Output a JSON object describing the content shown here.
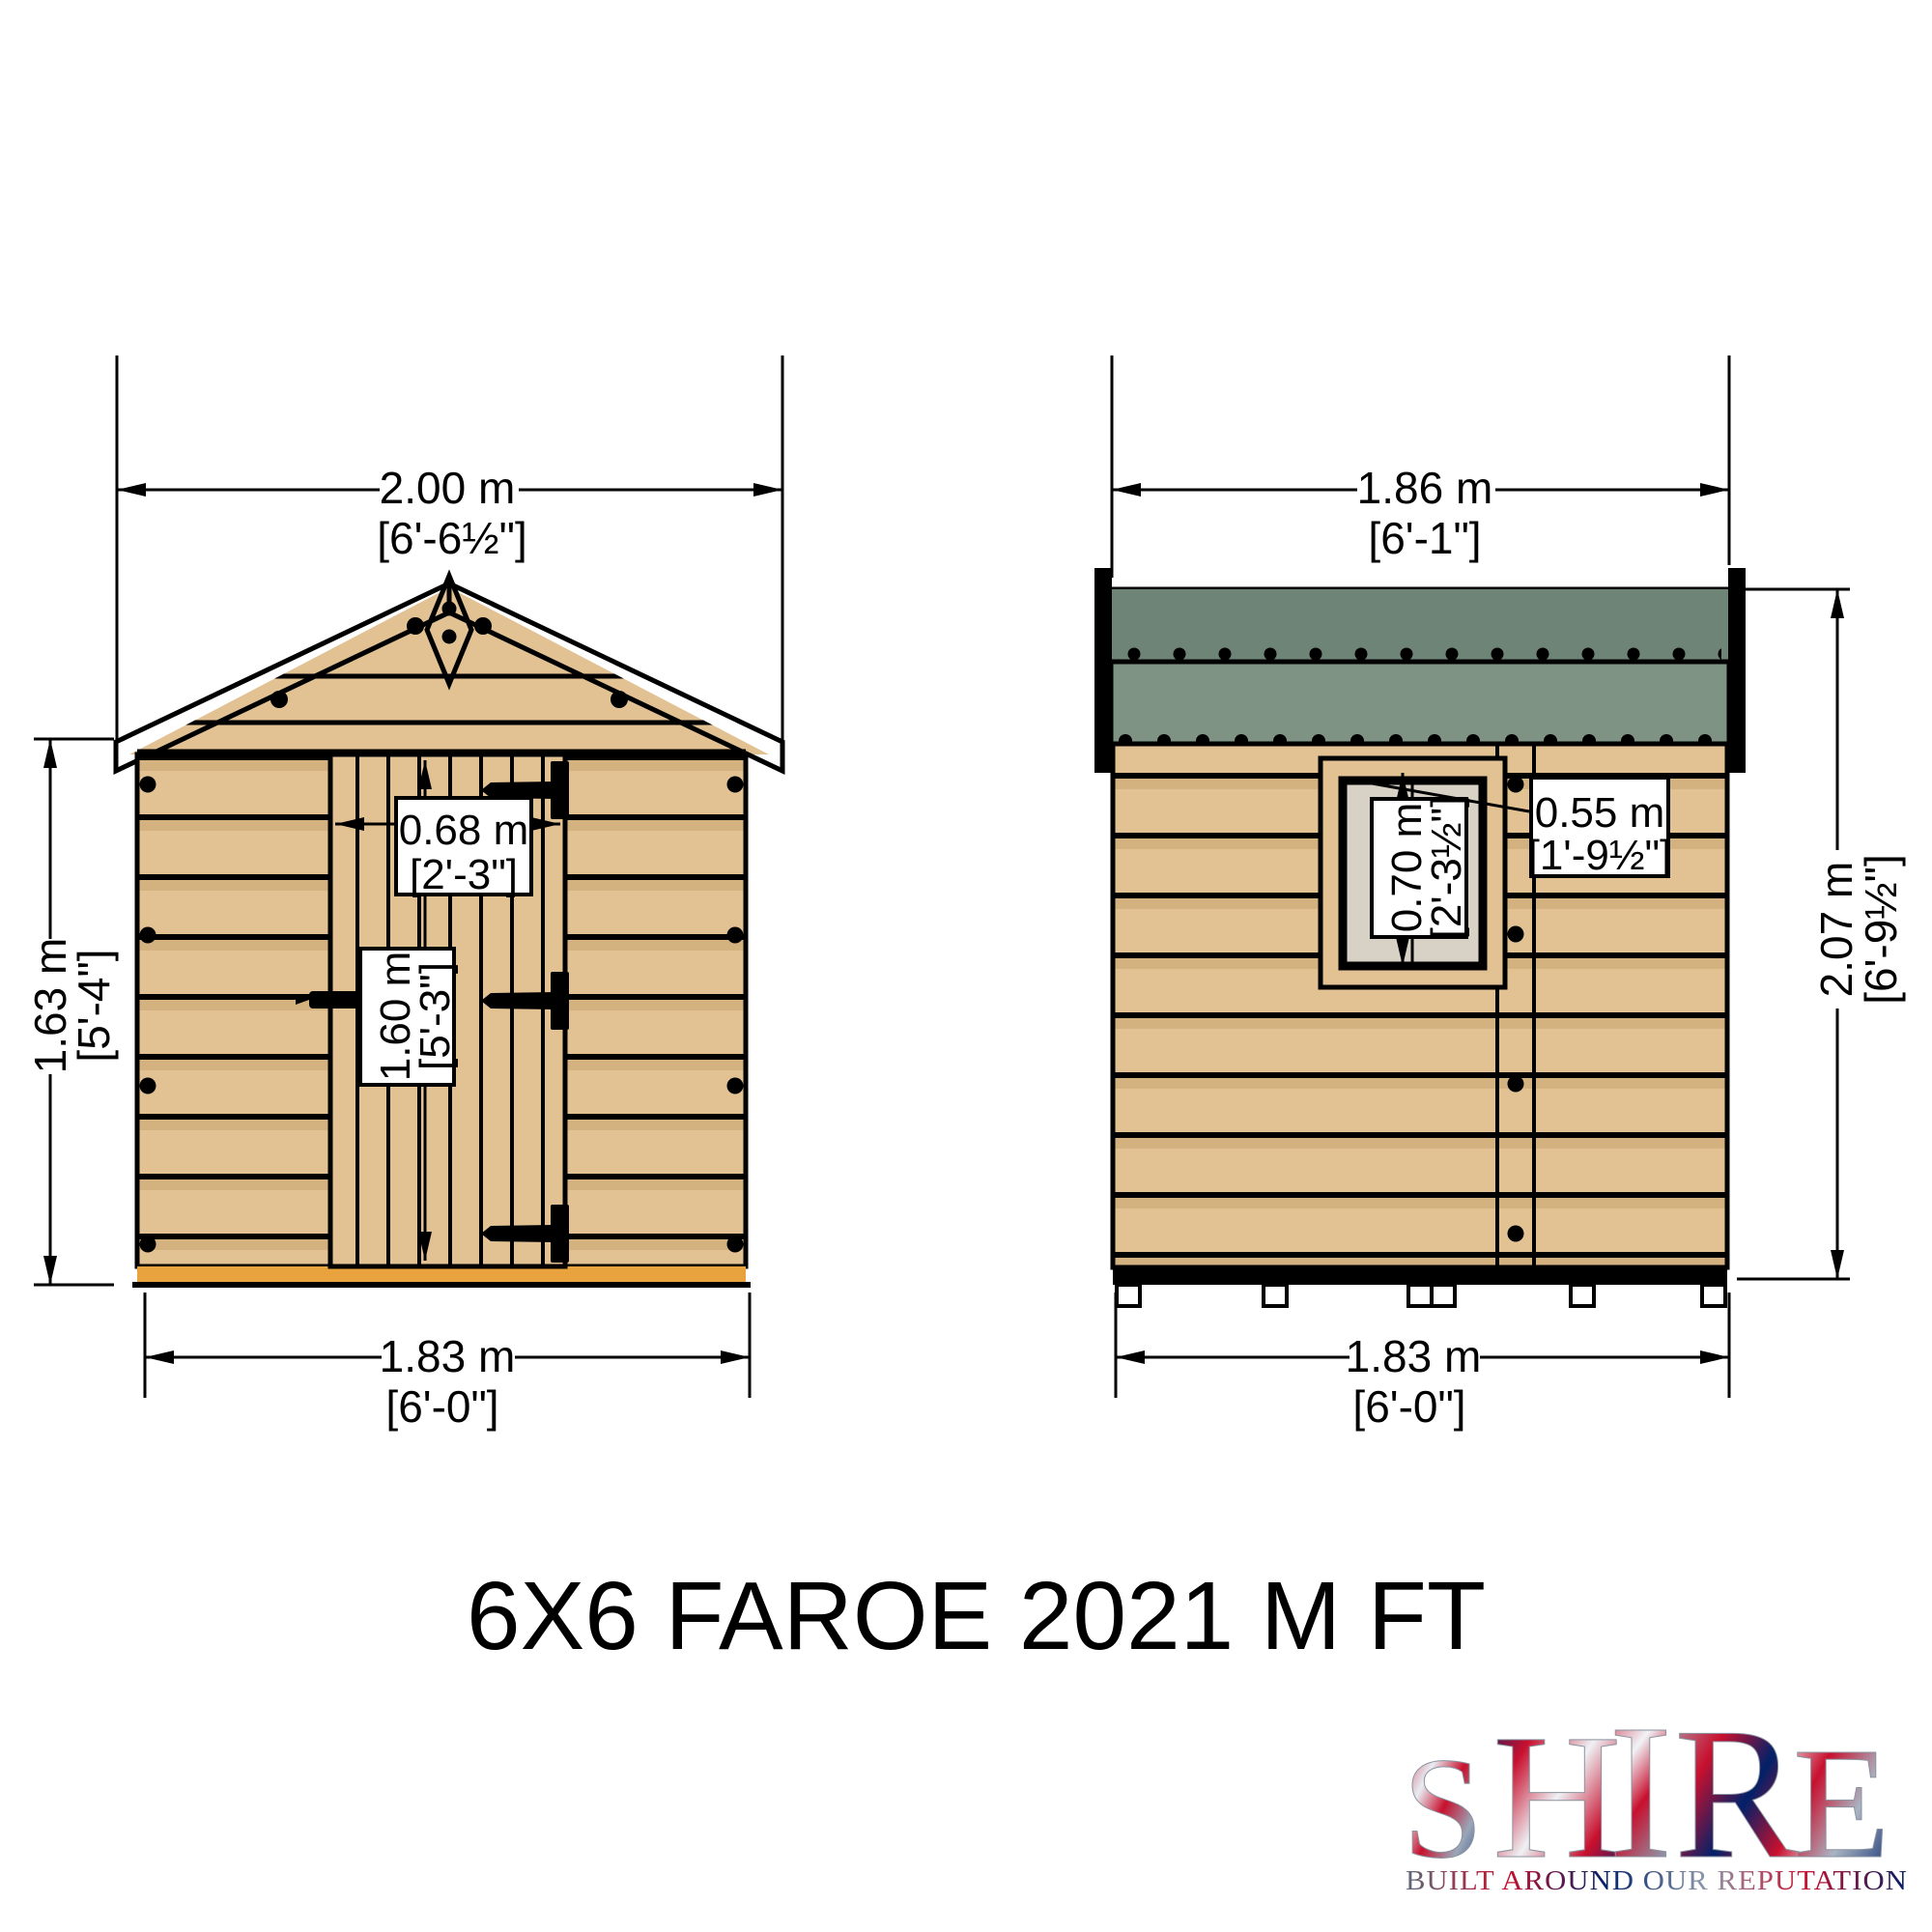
{
  "title": "6X6 FAROE 2021 M FT",
  "front_view": {
    "name": "front elevation",
    "roof_width": {
      "m": "2.00 m",
      "ft": "[6'-6½\"]"
    },
    "wall_height": {
      "m": "1.63 m",
      "ft": "[5'-4\"]"
    },
    "door_width": {
      "m": "0.68 m",
      "ft": "[2'-3\"]"
    },
    "door_height": {
      "m": "1.60 m",
      "ft": "[5'-3\"]"
    },
    "base_width": {
      "m": "1.83 m",
      "ft": "[6'-0\"]"
    }
  },
  "side_view": {
    "name": "side elevation",
    "top_width": {
      "m": "1.86 m",
      "ft": "[6'-1\"]"
    },
    "window_height": {
      "m": "0.70 m",
      "ft": "[2'-3½\"]"
    },
    "window_width": {
      "m": "0.55 m",
      "ft": "[1'-9½\"]"
    },
    "total_height": {
      "m": "2.07 m",
      "ft": "[6'-9½\"]"
    },
    "base_width": {
      "m": "1.83 m",
      "ft": "[6'-0\"]"
    }
  },
  "logo": {
    "letters": [
      "S",
      "H",
      "I",
      "R",
      "E"
    ],
    "tagline": "BUILT AROUND OUR REPUTATION"
  },
  "colors": {
    "wood": "#e2c193",
    "wood_shade": "#d4b27f",
    "roof_green": "#7e9383",
    "roof_green_dark": "#6e8477",
    "floor": "#e8a33f",
    "glass": "#d8d1c5",
    "flag_red": "#c8102e",
    "flag_blue": "#012169"
  }
}
